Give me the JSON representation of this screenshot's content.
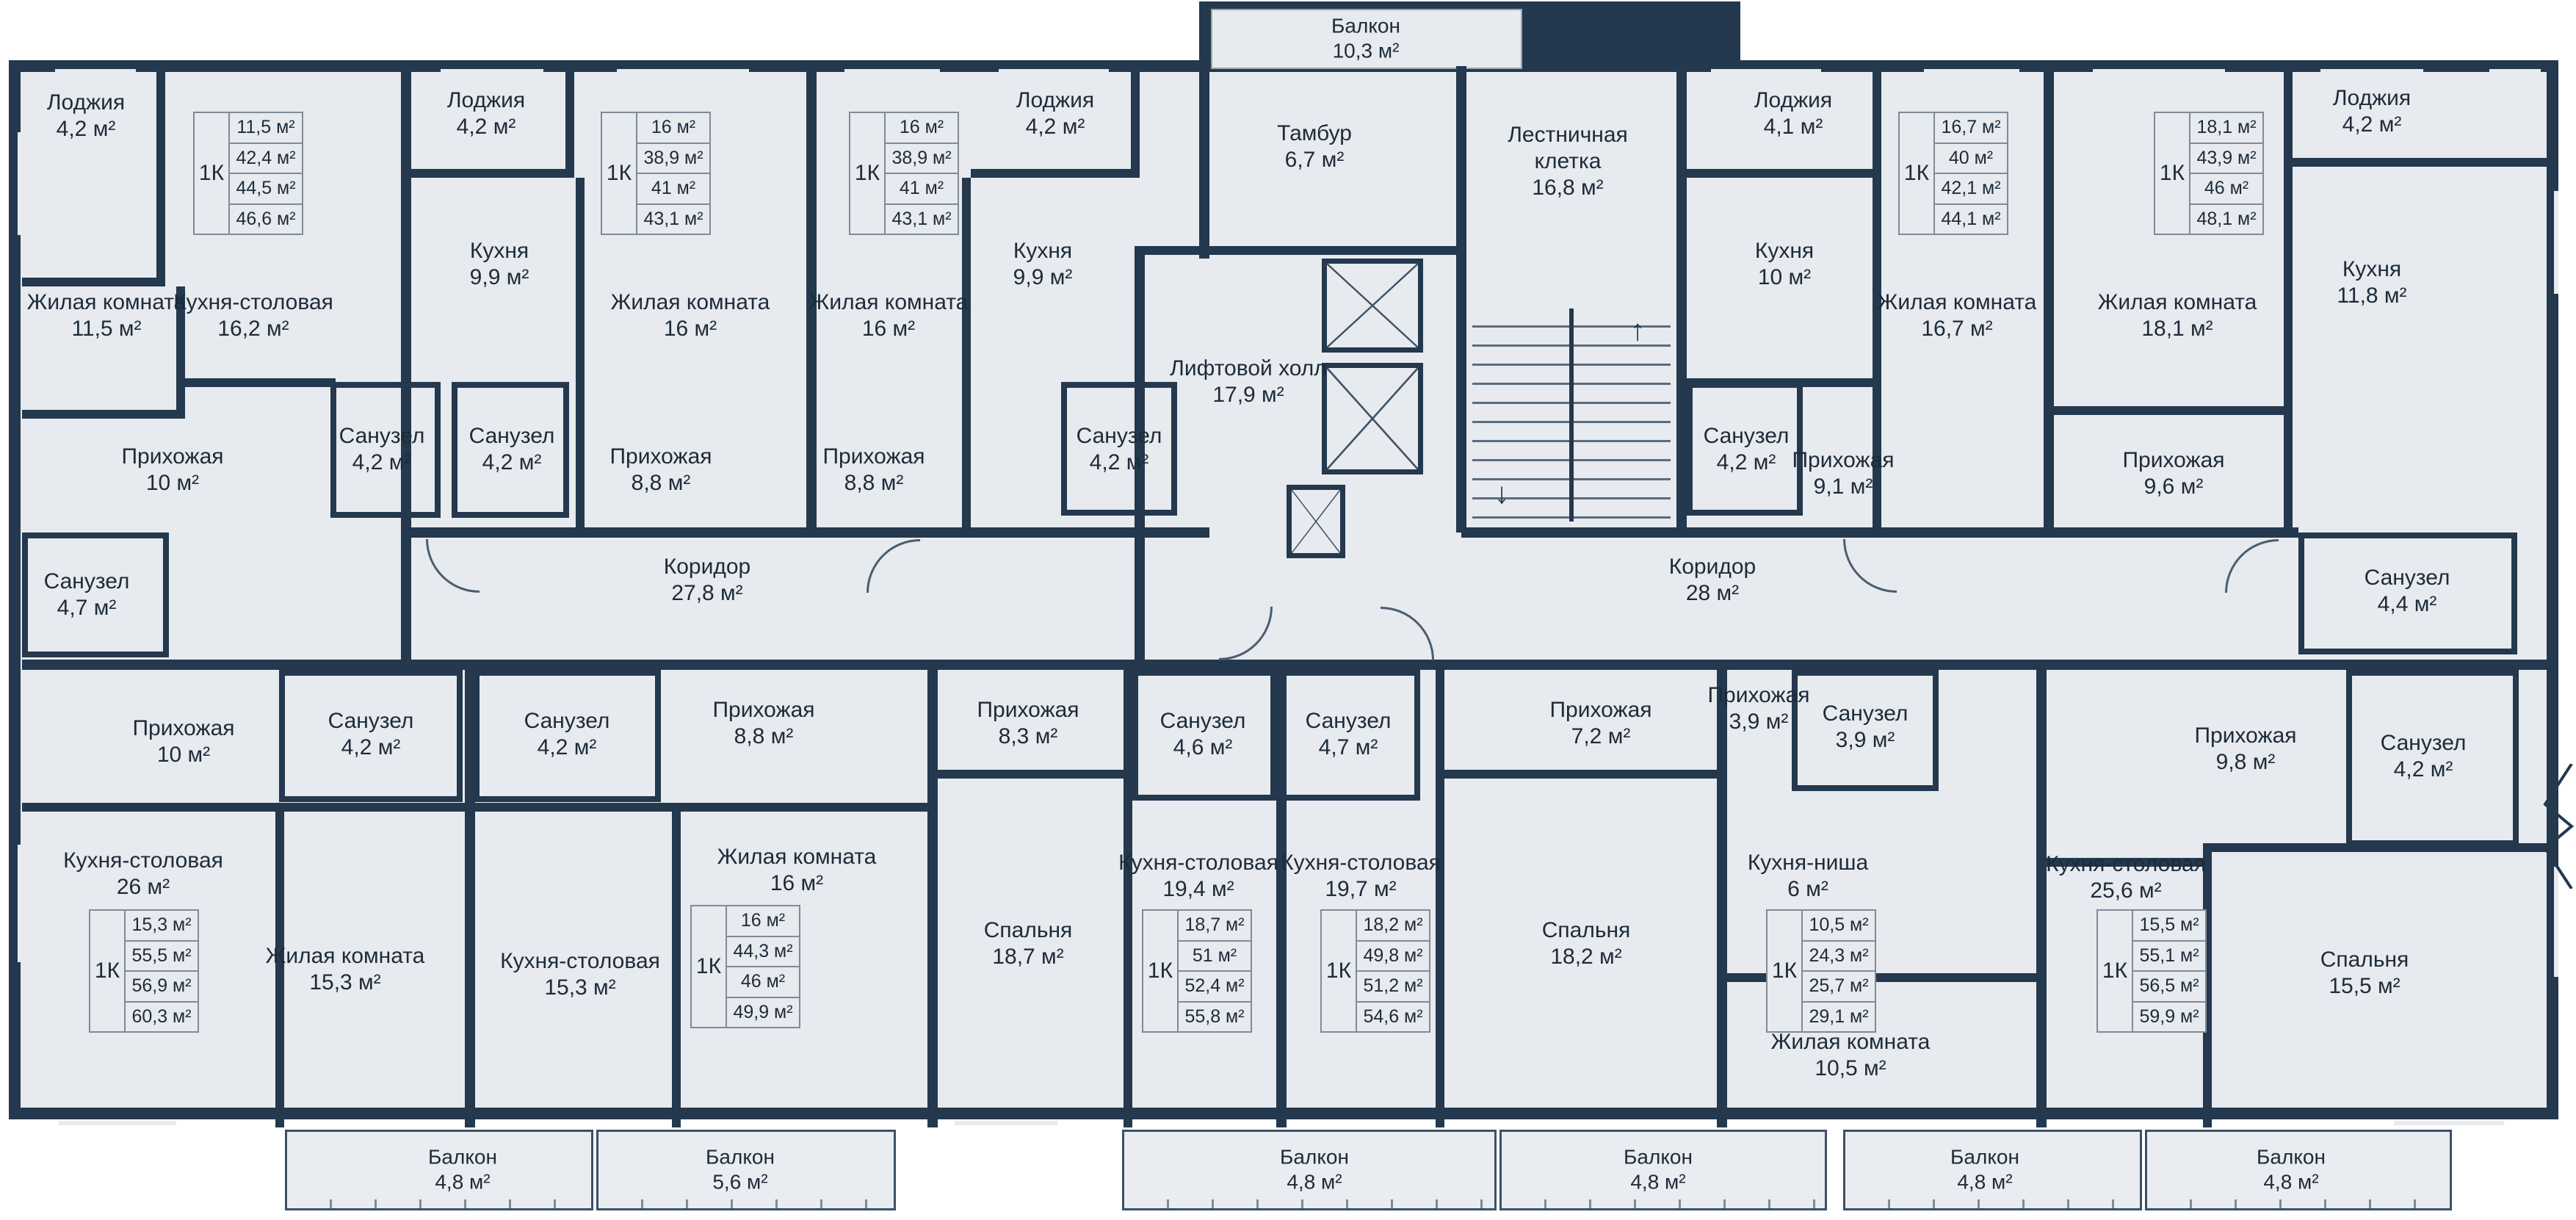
{
  "colors": {
    "wall": "#24384e",
    "floor": "#e7eaee",
    "background": "#ffffff",
    "card_border": "#7e8b99",
    "text": "#1d2b3a"
  },
  "labels": [
    {
      "name": "Лоджия",
      "area": "4,2 м²"
    },
    {
      "name": "Жилая комната",
      "area": "11,5 м²"
    },
    {
      "name": "Кухня-столовая",
      "area": "16,2 м²"
    },
    {
      "name": "Прихожая",
      "area": "10 м²"
    },
    {
      "name": "Санузел",
      "area": "4,2 м²"
    },
    {
      "name": "Санузел",
      "area": "4,7 м²"
    },
    {
      "name": "Лоджия",
      "area": "4,2 м²"
    },
    {
      "name": "Кухня",
      "area": "9,9 м²"
    },
    {
      "name": "Санузел",
      "area": "4,2 м²"
    },
    {
      "name": "Жилая комната",
      "area": "16 м²"
    },
    {
      "name": "Прихожая",
      "area": "8,8 м²"
    },
    {
      "name": "Лоджия",
      "area": "4,2 м²"
    },
    {
      "name": "Кухня",
      "area": "9,9 м²"
    },
    {
      "name": "Санузел",
      "area": "4,2 м²"
    },
    {
      "name": "Жилая комната",
      "area": "16 м²"
    },
    {
      "name": "Прихожая",
      "area": "8,8 м²"
    },
    {
      "name": "Балкон",
      "area": "10,3 м²"
    },
    {
      "name": "Тамбур",
      "area": "6,7 м²"
    },
    {
      "name": "Лестничная клетка",
      "area": "16,8 м²"
    },
    {
      "name": "Лифтовой холл",
      "area": "17,9 м²"
    },
    {
      "name": "Коридор",
      "area": "27,8 м²"
    },
    {
      "name": "Коридор",
      "area": "28 м²"
    },
    {
      "name": "Лоджия",
      "area": "4,1 м²"
    },
    {
      "name": "Кухня",
      "area": "10 м²"
    },
    {
      "name": "Санузел",
      "area": "4,2 м²"
    },
    {
      "name": "Жилая комната",
      "area": "16,7 м²"
    },
    {
      "name": "Прихожая",
      "area": "9,1 м²"
    },
    {
      "name": "Лоджия",
      "area": "4,2 м²"
    },
    {
      "name": "Кухня",
      "area": "11,8 м²"
    },
    {
      "name": "Жилая комната",
      "area": "18,1 м²"
    },
    {
      "name": "Прихожая",
      "area": "9,6 м²"
    },
    {
      "name": "Санузел",
      "area": "4,4 м²"
    },
    {
      "name": "Прихожая",
      "area": "10 м²"
    },
    {
      "name": "Санузел",
      "area": "4,2 м²"
    },
    {
      "name": "Кухня-столовая",
      "area": "26 м²"
    },
    {
      "name": "Жилая комната",
      "area": "15,3 м²"
    },
    {
      "name": "Санузел",
      "area": "4,2 м²"
    },
    {
      "name": "Прихожая",
      "area": "8,8 м²"
    },
    {
      "name": "Кухня-столовая",
      "area": "15,3 м²"
    },
    {
      "name": "Жилая комната",
      "area": "16 м²"
    },
    {
      "name": "Прихожая",
      "area": "8,3 м²"
    },
    {
      "name": "Санузел",
      "area": "4,6 м²"
    },
    {
      "name": "Спальня",
      "area": "18,7 м²"
    },
    {
      "name": "Кухня-столовая",
      "area": "19,4 м²"
    },
    {
      "name": "Санузел",
      "area": "4,7 м²"
    },
    {
      "name": "Кухня-столовая",
      "area": "19,7 м²"
    },
    {
      "name": "Прихожая",
      "area": "7,2 м²"
    },
    {
      "name": "Спальня",
      "area": "18,2 м²"
    },
    {
      "name": "Прихожая",
      "area": "3,9 м²"
    },
    {
      "name": "Санузел",
      "area": "3,9 м²"
    },
    {
      "name": "Кухня-ниша",
      "area": "6 м²"
    },
    {
      "name": "Жилая комната",
      "area": "10,5 м²"
    },
    {
      "name": "Прихожая",
      "area": "9,8 м²"
    },
    {
      "name": "Санузел",
      "area": "4,2 м²"
    },
    {
      "name": "Кухня-столовая",
      "area": "25,6 м²"
    },
    {
      "name": "Спальня",
      "area": "15,5 м²"
    },
    {
      "name": "Балкон",
      "area": "4,8 м²"
    },
    {
      "name": "Балкон",
      "area": "5,6 м²"
    },
    {
      "name": "Балкон",
      "area": "4,8 м²"
    },
    {
      "name": "Балкон",
      "area": "4,8 м²"
    },
    {
      "name": "Балкон",
      "area": "4,8 м²"
    },
    {
      "name": "Балкон",
      "area": "4,8 м²"
    }
  ],
  "cards": [
    {
      "type": "1К",
      "values": [
        "11,5 м²",
        "42,4 м²",
        "44,5 м²",
        "46,6 м²"
      ]
    },
    {
      "type": "1К",
      "values": [
        "16 м²",
        "38,9 м²",
        "41 м²",
        "43,1 м²"
      ]
    },
    {
      "type": "1К",
      "values": [
        "16 м²",
        "38,9 м²",
        "41 м²",
        "43,1 м²"
      ]
    },
    {
      "type": "1К",
      "values": [
        "16,7 м²",
        "40 м²",
        "42,1 м²",
        "44,1 м²"
      ]
    },
    {
      "type": "1К",
      "values": [
        "18,1 м²",
        "43,9 м²",
        "46 м²",
        "48,1 м²"
      ]
    },
    {
      "type": "1К",
      "values": [
        "15,3 м²",
        "55,5 м²",
        "56,9 м²",
        "60,3 м²"
      ]
    },
    {
      "type": "1К",
      "values": [
        "16 м²",
        "44,3 м²",
        "46 м²",
        "49,9 м²"
      ]
    },
    {
      "type": "1К",
      "values": [
        "18,7 м²",
        "51 м²",
        "52,4 м²",
        "55,8 м²"
      ]
    },
    {
      "type": "1К",
      "values": [
        "18,2 м²",
        "49,8 м²",
        "51,2 м²",
        "54,6 м²"
      ]
    },
    {
      "type": "1К",
      "values": [
        "10,5 м²",
        "24,3 м²",
        "25,7 м²",
        "29,1 м²"
      ]
    },
    {
      "type": "1К",
      "values": [
        "15,5 м²",
        "55,1 м²",
        "56,5 м²",
        "59,9 м²"
      ]
    }
  ],
  "stairs": {
    "up_arrow": "↑",
    "down_arrow": "↓"
  }
}
